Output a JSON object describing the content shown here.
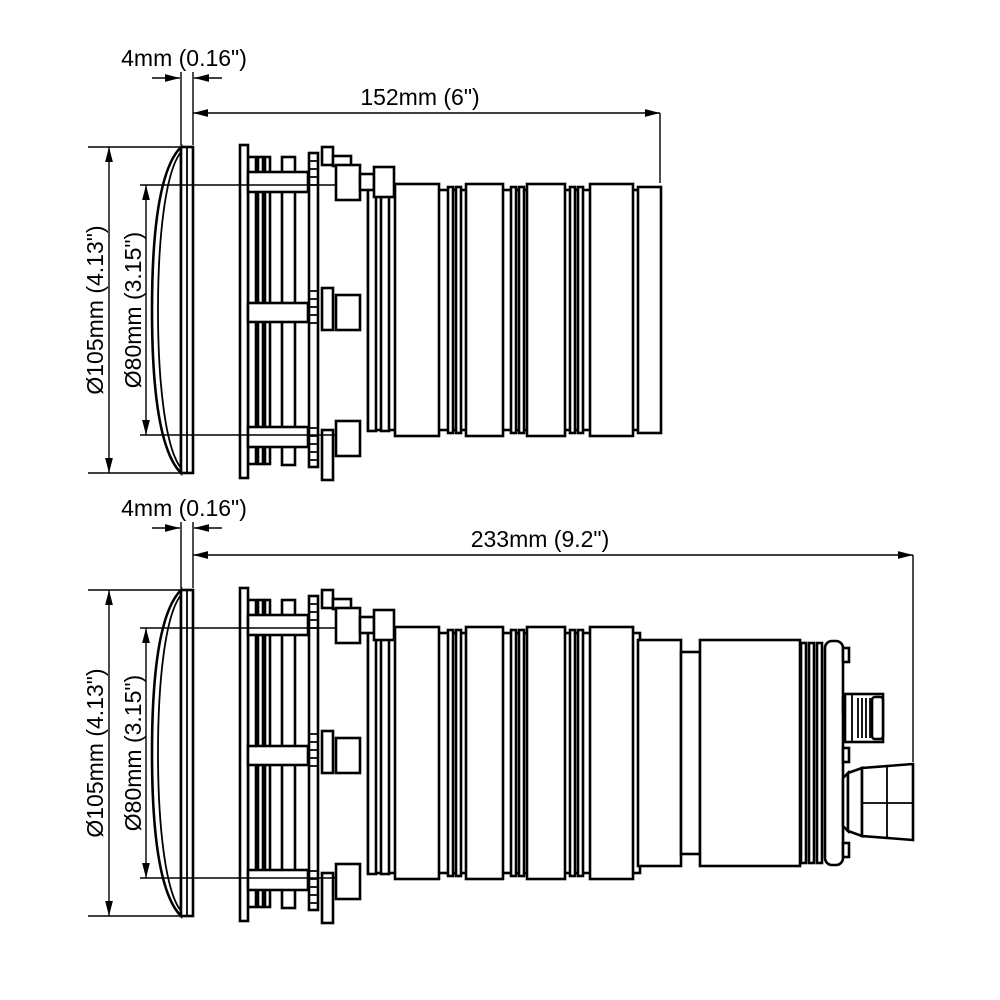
{
  "views": {
    "top": {
      "name": "short housing side view",
      "labels": {
        "flange_thickness": "4mm (0.16\")",
        "overall_length": "152mm (6\")",
        "flange_diameter": "Ø105mm (4.13\")",
        "body_diameter": "Ø80mm (3.15\")"
      }
    },
    "bottom": {
      "name": "long housing side view",
      "labels": {
        "flange_thickness": "4mm (0.16\")",
        "overall_length": "233mm (9.2\")",
        "flange_diameter": "Ø105mm (4.13\")",
        "body_diameter": "Ø80mm (3.15\")"
      }
    }
  },
  "colors": {
    "line": "#000000",
    "background": "#ffffff"
  }
}
